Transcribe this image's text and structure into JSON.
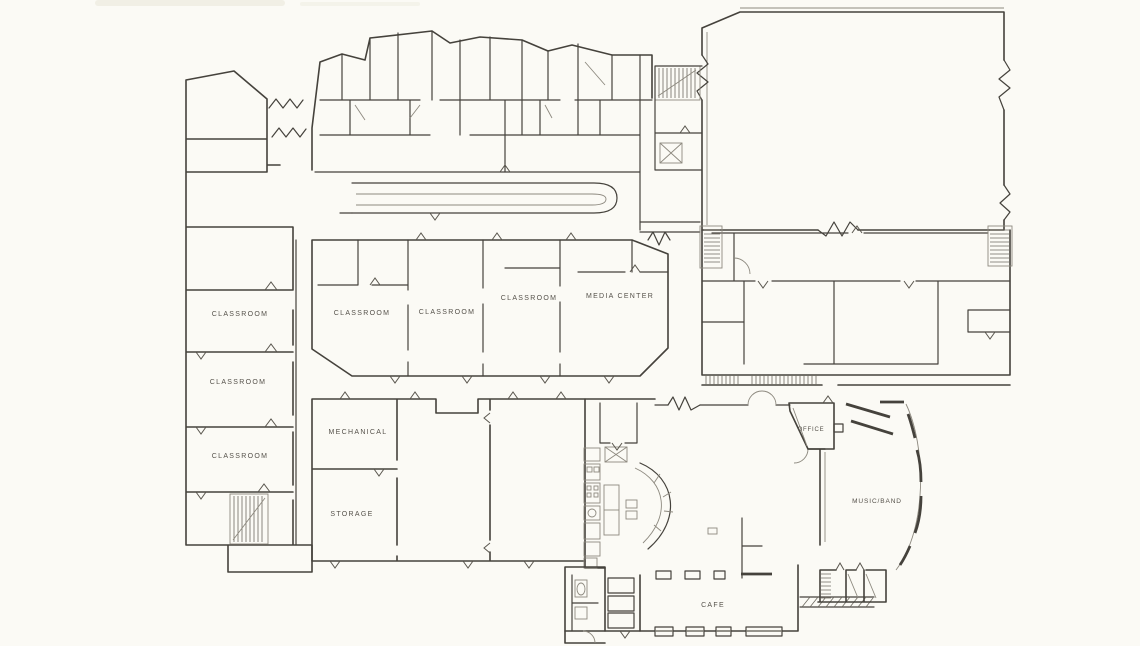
{
  "document": {
    "type": "scanned hand-sketched architectural floor plan of a school",
    "paper_color": "#fbfaf5",
    "ink_color": "#45423c"
  },
  "rooms": [
    {
      "id": "classroom-west-1",
      "label": "CLASSROOM"
    },
    {
      "id": "classroom-west-2",
      "label": "CLASSROOM"
    },
    {
      "id": "classroom-west-3",
      "label": "CLASSROOM"
    },
    {
      "id": "classroom-mid-1",
      "label": "CLASSROOM"
    },
    {
      "id": "classroom-mid-2",
      "label": "CLASSROOM"
    },
    {
      "id": "classroom-mid-3",
      "label": "CLASSROOM"
    },
    {
      "id": "media-center",
      "label": "MEDIA CENTER"
    },
    {
      "id": "mechanical",
      "label": "MECHANICAL"
    },
    {
      "id": "storage",
      "label": "STORAGE"
    },
    {
      "id": "office",
      "label": "OFFICE"
    },
    {
      "id": "music-band",
      "label": "MUSIC/BAND"
    },
    {
      "id": "cafe",
      "label": "CAFE"
    }
  ]
}
